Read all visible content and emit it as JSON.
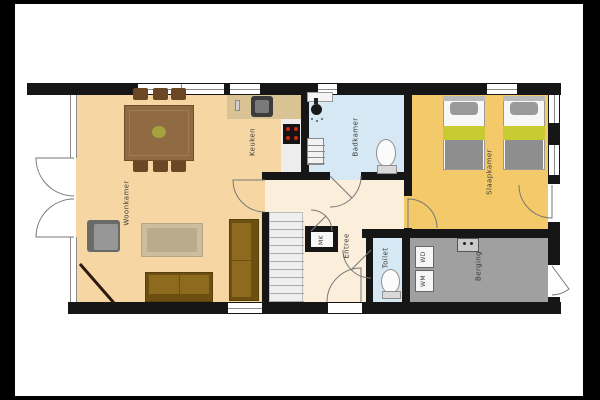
{
  "title": "floor-plan",
  "palette": {
    "wall": "#161616",
    "frame": "#000000",
    "background": "#ffffff",
    "arc_stroke": "#777777",
    "window_line": "#8a8a8a",
    "woonkamer_floor": "#f6d7a4",
    "entree_floor": "#fbeedb",
    "badkamer_floor": "#d6e8f3",
    "slaapkamer_floor": "#f3c969",
    "berging_floor": "#a0a0a0",
    "counter": "#d9c395"
  },
  "floors": [
    {
      "name": "woonkamer-floor",
      "x": 76,
      "y": 90,
      "w": 229,
      "h": 215,
      "fill": "#f6d7a4"
    },
    {
      "name": "entree-floor",
      "x": 265,
      "y": 175,
      "w": 147,
      "h": 130,
      "fill": "#fbeedb"
    },
    {
      "name": "badkamer-floor",
      "x": 305,
      "y": 90,
      "w": 107,
      "h": 90,
      "fill": "#d6e8f3"
    },
    {
      "name": "slaapkamer-floor",
      "x": 404,
      "y": 90,
      "w": 144,
      "h": 148,
      "fill": "#f3c969"
    },
    {
      "name": "berging-floor",
      "x": 402,
      "y": 229,
      "w": 146,
      "h": 76,
      "fill": "#a0a0a0"
    },
    {
      "name": "toilet-floor",
      "x": 366,
      "y": 229,
      "w": 44,
      "h": 73,
      "fill": "#d6e8f3"
    },
    {
      "name": "kitchen-counter",
      "x": 227,
      "y": 90,
      "w": 75,
      "h": 29,
      "fill": "#d9c395"
    },
    {
      "name": "kitchen-counter-side",
      "x": 281,
      "y": 119,
      "w": 21,
      "h": 53,
      "fill": "#ededed"
    }
  ],
  "walls": [
    {
      "name": "wall-top",
      "x": 27,
      "y": 83,
      "w": 534,
      "h": 12
    },
    {
      "name": "wall-bottom",
      "x": 68,
      "y": 302,
      "w": 493,
      "h": 12
    },
    {
      "name": "wall-right",
      "x": 548,
      "y": 83,
      "w": 12,
      "h": 231
    },
    {
      "name": "wall-bath-left",
      "x": 301,
      "y": 90,
      "w": 8,
      "h": 90
    },
    {
      "name": "wall-bedroom-left-upper",
      "x": 404,
      "y": 90,
      "w": 8,
      "h": 106
    },
    {
      "name": "wall-bedroom-left-lower",
      "x": 404,
      "y": 228,
      "w": 8,
      "h": 10
    },
    {
      "name": "wall-hall-top-a",
      "x": 262,
      "y": 172,
      "w": 68,
      "h": 8
    },
    {
      "name": "wall-hall-top-b",
      "x": 361,
      "y": 172,
      "w": 51,
      "h": 8
    },
    {
      "name": "wall-stairs",
      "x": 262,
      "y": 212,
      "w": 7,
      "h": 90
    },
    {
      "name": "wall-storage-top",
      "x": 362,
      "y": 229,
      "w": 186,
      "h": 9
    },
    {
      "name": "wall-toilet-left",
      "x": 366,
      "y": 238,
      "w": 7,
      "h": 64
    },
    {
      "name": "wall-toilet-right",
      "x": 402,
      "y": 238,
      "w": 8,
      "h": 64
    },
    {
      "name": "wall-mk-box",
      "x": 305,
      "y": 226,
      "w": 33,
      "h": 26
    }
  ],
  "windows": [
    {
      "name": "window-living-top",
      "x": 138,
      "y": 84,
      "w": 86,
      "h": 10,
      "o": "h",
      "div": 1
    },
    {
      "name": "window-kitchen-top",
      "x": 230,
      "y": 84,
      "w": 30,
      "h": 10,
      "o": "h"
    },
    {
      "name": "window-bath-top",
      "x": 318,
      "y": 84,
      "w": 19,
      "h": 10,
      "o": "h"
    },
    {
      "name": "window-bedroom-top",
      "x": 487,
      "y": 84,
      "w": 30,
      "h": 10,
      "o": "h"
    },
    {
      "name": "window-bedroom-right-1",
      "x": 549,
      "y": 95,
      "w": 10,
      "h": 28,
      "o": "v"
    },
    {
      "name": "window-bedroom-right-2",
      "x": 549,
      "y": 145,
      "w": 10,
      "h": 30,
      "o": "v"
    },
    {
      "name": "opening-bedroom-right-door",
      "x": 548,
      "y": 184,
      "w": 12,
      "h": 38,
      "o": "blank"
    },
    {
      "name": "opening-berging-door",
      "x": 548,
      "y": 265,
      "w": 12,
      "h": 32,
      "o": "blank"
    },
    {
      "name": "window-living-bottom",
      "x": 228,
      "y": 303,
      "w": 34,
      "h": 10,
      "o": "h"
    },
    {
      "name": "opening-front-door",
      "x": 328,
      "y": 303,
      "w": 34,
      "h": 10,
      "o": "blank"
    },
    {
      "name": "glass-wall-upper",
      "x": 70,
      "y": 95,
      "w": 7,
      "h": 63,
      "o": "glass"
    },
    {
      "name": "glass-wall-lower",
      "x": 70,
      "y": 237,
      "w": 7,
      "h": 65,
      "o": "glass"
    }
  ],
  "shapes": [
    {
      "name": "mk-interior",
      "x": 311,
      "y": 232,
      "w": 22,
      "h": 15,
      "fill": "#f7f7f7"
    },
    {
      "name": "staircase",
      "type": "stairs",
      "x": 269,
      "y": 212,
      "w": 34,
      "h": 90,
      "step": 8,
      "fill": "#efefef",
      "line": "#a8a8a8",
      "bd": "1px solid #bdbdbd"
    },
    {
      "name": "dining-chair",
      "x": 133,
      "y": 88,
      "w": 15,
      "h": 12,
      "fill": "#6b4726",
      "rad": 2
    },
    {
      "name": "dining-chair",
      "x": 153,
      "y": 88,
      "w": 15,
      "h": 12,
      "fill": "#6b4726",
      "rad": 2
    },
    {
      "name": "dining-chair",
      "x": 171,
      "y": 88,
      "w": 15,
      "h": 12,
      "fill": "#6b4726",
      "rad": 2
    },
    {
      "name": "dining-chair",
      "x": 133,
      "y": 159,
      "w": 15,
      "h": 13,
      "fill": "#6b4726",
      "rad": 2
    },
    {
      "name": "dining-chair",
      "x": 153,
      "y": 159,
      "w": 15,
      "h": 13,
      "fill": "#6b4726",
      "rad": 2
    },
    {
      "name": "dining-chair",
      "x": 171,
      "y": 159,
      "w": 15,
      "h": 13,
      "fill": "#6b4726",
      "rad": 2
    },
    {
      "name": "dining-table",
      "x": 124,
      "y": 105,
      "w": 70,
      "h": 56,
      "fill": "#8f6a42",
      "bd": "1px solid #6e4d2a"
    },
    {
      "name": "dining-table-grain",
      "x": 129,
      "y": 110,
      "w": 60,
      "h": 46,
      "fill": "transparent",
      "bd": "1px solid #a07c50"
    },
    {
      "name": "table-plant",
      "type": "ellipse",
      "x": 152,
      "y": 126,
      "w": 14,
      "h": 12,
      "fill": "#a3a23f"
    },
    {
      "name": "armchair",
      "x": 87,
      "y": 220,
      "w": 33,
      "h": 32,
      "fill": "#6a6a6a",
      "rad": 3
    },
    {
      "name": "armchair-cushion",
      "x": 94,
      "y": 224,
      "w": 24,
      "h": 26,
      "fill": "#979797",
      "rad": 2
    },
    {
      "name": "rug",
      "x": 141,
      "y": 223,
      "w": 62,
      "h": 34,
      "fill": "#cbbd9e",
      "bd": "1px solid #b3a585"
    },
    {
      "name": "rug-inner",
      "x": 147,
      "y": 228,
      "w": 50,
      "h": 24,
      "fill": "#b9ab8c"
    },
    {
      "name": "sofa-south",
      "x": 145,
      "y": 272,
      "w": 68,
      "h": 30,
      "fill": "#6e4f12",
      "bd": "1px solid #55400c"
    },
    {
      "name": "sofa-south-cushion",
      "x": 149,
      "y": 275,
      "w": 30,
      "h": 19,
      "fill": "#8d6a1d"
    },
    {
      "name": "sofa-south-cushion",
      "x": 180,
      "y": 275,
      "w": 29,
      "h": 19,
      "fill": "#8d6a1d"
    },
    {
      "name": "sofa-east",
      "x": 229,
      "y": 219,
      "w": 30,
      "h": 82,
      "fill": "#6e4f12",
      "bd": "1px solid #55400c"
    },
    {
      "name": "sofa-east-cushion",
      "x": 232,
      "y": 223,
      "w": 19,
      "h": 37,
      "fill": "#8d6a1d"
    },
    {
      "name": "sofa-east-cushion",
      "x": 232,
      "y": 261,
      "w": 19,
      "h": 36,
      "fill": "#8d6a1d"
    },
    {
      "name": "kitchen-sink",
      "x": 251,
      "y": 96,
      "w": 22,
      "h": 21,
      "fill": "#3c3c3c",
      "rad": 3
    },
    {
      "name": "kitchen-sink-basin",
      "x": 255,
      "y": 100,
      "w": 14,
      "h": 13,
      "fill": "#7a7a7a",
      "rad": 2
    },
    {
      "name": "kitchen-faucet",
      "x": 235,
      "y": 100,
      "w": 5,
      "h": 11,
      "fill": "#cfcfcf",
      "bd": "1px solid #8a8a8a"
    },
    {
      "name": "stove",
      "x": 283,
      "y": 124,
      "w": 17,
      "h": 20,
      "fill": "#141414"
    },
    {
      "name": "stove-burners",
      "type": "dots",
      "points": [
        [
          288,
          129
        ],
        [
          296,
          129
        ],
        [
          288,
          138
        ],
        [
          296,
          138
        ]
      ],
      "r": 2,
      "fill": "#d02810"
    },
    {
      "name": "bath-basin",
      "x": 307,
      "y": 92,
      "w": 26,
      "h": 10,
      "fill": "#f4f4f4",
      "bd": "1px solid #9a9a9a"
    },
    {
      "name": "shower-arm",
      "x": 314,
      "y": 98,
      "w": 4,
      "h": 6,
      "fill": "#222222"
    },
    {
      "name": "shower-head",
      "type": "ellipse",
      "x": 311,
      "y": 104,
      "w": 11,
      "h": 11,
      "fill": "#181818"
    },
    {
      "name": "shower-spray",
      "type": "dots",
      "points": [
        [
          312,
          119
        ],
        [
          317,
          121
        ],
        [
          322,
          119
        ]
      ],
      "r": 1,
      "fill": "#555555"
    },
    {
      "name": "bath-radiator",
      "type": "stairs",
      "x": 307,
      "y": 138,
      "w": 17,
      "h": 27,
      "step": 6,
      "fill": "#f2f2f2",
      "line": "#8a8a8a",
      "bd": "1px solid #8a8a8a"
    },
    {
      "name": "bath-toilet-bowl",
      "type": "ellipse",
      "x": 376,
      "y": 139,
      "w": 20,
      "h": 28,
      "fill": "#fbfbfb",
      "bd": "1px solid #909090"
    },
    {
      "name": "bath-toilet-tank",
      "x": 377,
      "y": 165,
      "w": 20,
      "h": 9,
      "fill": "#d9d9d9",
      "bd": "1px solid #909090"
    },
    {
      "name": "wc-toilet-bowl",
      "type": "ellipse",
      "x": 381,
      "y": 269,
      "w": 19,
      "h": 25,
      "fill": "#fbfbfb",
      "bd": "1px solid #909090"
    },
    {
      "name": "wc-toilet-tank",
      "x": 382,
      "y": 291,
      "w": 19,
      "h": 8,
      "fill": "#d9d9d9",
      "bd": "1px solid #909090"
    },
    {
      "name": "cv-unit",
      "x": 457,
      "y": 238,
      "w": 22,
      "h": 14,
      "fill": "#c9c9c9",
      "bd": "1px solid #555555"
    },
    {
      "name": "cv-unit-dots",
      "type": "dots",
      "points": [
        [
          464,
          243
        ],
        [
          471,
          243
        ]
      ],
      "r": 1.5,
      "fill": "#222222"
    },
    {
      "name": "dryer-box",
      "x": 415,
      "y": 246,
      "w": 19,
      "h": 22,
      "fill": "#f6f6f6",
      "bd": "1px solid #666666"
    },
    {
      "name": "washer-box",
      "x": 415,
      "y": 270,
      "w": 19,
      "h": 22,
      "fill": "#f6f6f6",
      "bd": "1px solid #666666"
    },
    {
      "name": "bed-frame",
      "x": 443,
      "y": 96,
      "w": 42,
      "h": 74,
      "fill": "#f7f7f7",
      "bd": "1px solid #9a9a9a"
    },
    {
      "name": "bed-headboard",
      "x": 443,
      "y": 96,
      "w": 42,
      "h": 5,
      "fill": "#bbbbbb"
    },
    {
      "name": "bed-pillow",
      "x": 450,
      "y": 102,
      "w": 28,
      "h": 13,
      "fill": "#9a9a9a",
      "rad": 4
    },
    {
      "name": "bed-band",
      "x": 443,
      "y": 126,
      "w": 42,
      "h": 14,
      "fill": "#c9cb33"
    },
    {
      "name": "bed-blanket",
      "x": 445,
      "y": 140,
      "w": 38,
      "h": 29,
      "fill": "#8e8e8e"
    },
    {
      "name": "bed-frame",
      "x": 503,
      "y": 96,
      "w": 42,
      "h": 74,
      "fill": "#f7f7f7",
      "bd": "1px solid #9a9a9a"
    },
    {
      "name": "bed-headboard",
      "x": 503,
      "y": 96,
      "w": 42,
      "h": 5,
      "fill": "#bbbbbb"
    },
    {
      "name": "bed-pillow",
      "x": 510,
      "y": 102,
      "w": 28,
      "h": 13,
      "fill": "#9a9a9a",
      "rad": 4
    },
    {
      "name": "bed-band",
      "x": 503,
      "y": 126,
      "w": 42,
      "h": 14,
      "fill": "#c9cb33"
    },
    {
      "name": "bed-blanket",
      "x": 505,
      "y": 140,
      "w": 38,
      "h": 29,
      "fill": "#8e8e8e"
    }
  ],
  "arcs": [
    {
      "name": "french-door-top-arc",
      "d": "M74,158 L36,158 A38,38 0 0 0 74,196"
    },
    {
      "name": "french-door-bottom-arc",
      "d": "M74,237 L36,237 A38,38 0 0 1 74,199"
    },
    {
      "name": "living-door-arc",
      "d": "M265,180 L233,180 A32,32 0 0 0 265,212"
    },
    {
      "name": "bath-door-arc",
      "d": "M330,176 L352,198 M361,176 A31,31 0 0 1 330,207"
    },
    {
      "name": "mk-door-arc",
      "d": "M311,210 A21,21 0 0 1 332,231 M311,231 L326,216"
    },
    {
      "name": "toilet-door-arc",
      "d": "M343,250 A28,28 0 0 0 371,278 M371,250 L351,270"
    },
    {
      "name": "front-door-arc",
      "d": "M361,302 L361,268 A34,34 0 0 0 327,302"
    },
    {
      "name": "bedroom-door-arc",
      "d": "M408,228 L408,199 A29,29 0 0 1 437,228"
    },
    {
      "name": "bedroom-right-door-arc",
      "d": "M552,185 L552,218 A33,33 0 0 1 519,185"
    },
    {
      "name": "berging-door-arc",
      "d": "M552,266 L569,289 A29,29 0 0 1 552,295"
    },
    {
      "name": "section-line",
      "d": "M80,264 L114,303",
      "stroke": "#2b1b0e",
      "width": 3
    }
  ],
  "labels": [
    {
      "name": "room-label-woonkamer",
      "text": "Woonkamer",
      "x": 127,
      "y": 203
    },
    {
      "name": "room-label-keuken",
      "text": "Keuken",
      "x": 253,
      "y": 142
    },
    {
      "name": "room-label-badkamer",
      "text": "Badkamer",
      "x": 356,
      "y": 137
    },
    {
      "name": "room-label-slaapkamer",
      "text": "Slaapkamer",
      "x": 490,
      "y": 172
    },
    {
      "name": "room-label-entree",
      "text": "Entree",
      "x": 347,
      "y": 246
    },
    {
      "name": "room-label-toilet",
      "text": "Toilet",
      "x": 386,
      "y": 258
    },
    {
      "name": "room-label-berging",
      "text": "Berging",
      "x": 479,
      "y": 266
    },
    {
      "name": "room-label-mk",
      "text": "MK",
      "x": 322,
      "y": 240,
      "size": 6
    },
    {
      "name": "appliance-label-wd",
      "text": "WD",
      "x": 424,
      "y": 257,
      "size": 6
    },
    {
      "name": "appliance-label-wm",
      "text": "WM",
      "x": 424,
      "y": 281,
      "size": 6
    }
  ]
}
